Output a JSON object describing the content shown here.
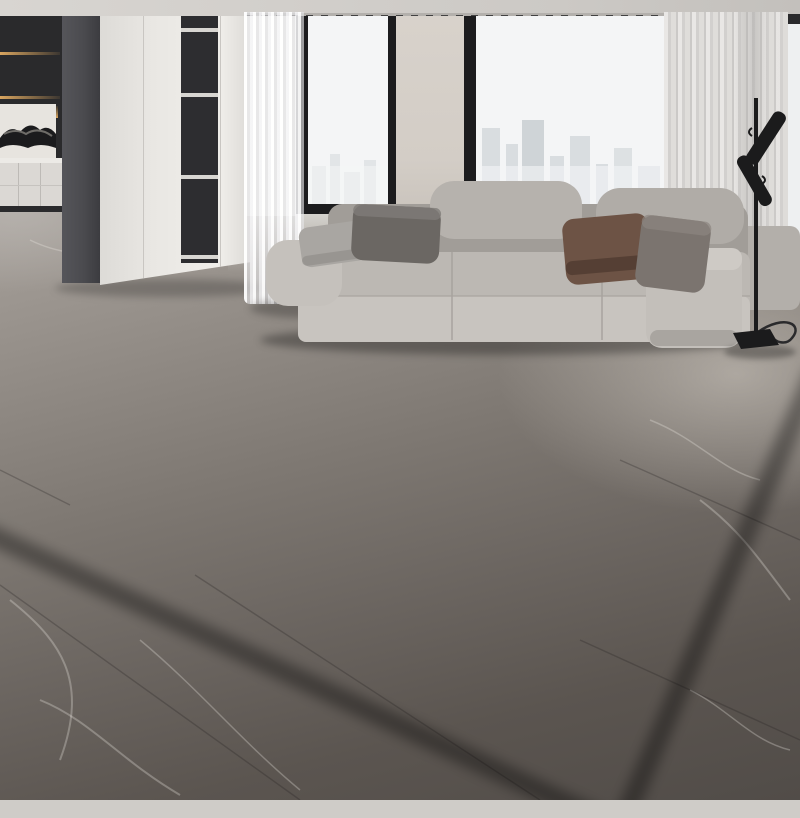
{
  "image": {
    "kind": "product-photo",
    "subject": "gold greek-key marble-print area rug in a modern living room",
    "width_px": 800,
    "height_px": 800
  },
  "palette": {
    "ceiling": "#d8d5d1",
    "track": "#b3b0ac",
    "window_frame": "#1c1c1e",
    "window_view": "#f4f5f6",
    "skyline": "#d9dde0",
    "wall_pier": "#d3cdc6",
    "curtain_left": "#f5f4f3",
    "curtain_right": "#dbd9d7",
    "kitchen_dark": "#2a2a2c",
    "kitchen_glow": "#d9a55f",
    "counter": "#eceae6",
    "base_cabinet": "#dbd8d4",
    "partition": "#4b4b4f",
    "wardrobe": "#e9e7e3",
    "niche": "#2d2d30",
    "floor_light": "#a8a29c",
    "floor_dark": "#514c48",
    "floor_vein": "#eeece6",
    "sofa": "#bcb8b3",
    "sofa_dark": "#a19d98",
    "pillow_gray": "#a9a6a2",
    "pillow_dark": "#6b6763",
    "pillow_brown": "#6d5345",
    "pillow_taupe": "#7b746f",
    "lamp": "#1b1b1c",
    "rug_binding": "#f2ecdd",
    "rug_margin": "#d8cfbc",
    "rug_grid_gold": "#c79d35",
    "rug_trim_light": "#fdf3b8",
    "rug_trim_mid": "#ddb84d",
    "rug_trim_dark": "#8a671f",
    "rug_band": "#8d7c67",
    "rug_band_dark": "#6f5f4c",
    "rug_key_gold": "#f1dd90",
    "rug_key_shadow": "#66501f",
    "rug_black": "#17171a",
    "rug_white": "#e9eaec",
    "rug_gold": "#dfae45",
    "rug_gold_light": "#f4d87c",
    "rug_gold_dark": "#a07a20"
  },
  "scene": {
    "setting": "modern high-rise living room",
    "rug": {
      "shape": "rectangle",
      "border_pattern": "greek-key meander on taupe band with gold bevel trim",
      "outer_field": "beige marble with gold diamond lattice and star sparkles",
      "inner_field": "black and white marble with gold foil veining and splatter",
      "edge": "cream binding"
    },
    "sofa": {
      "style": "modular with fold-down headrests",
      "pillow_count": 4
    },
    "lamp": {
      "type": "floor lamp",
      "heads": 2,
      "base": "square plate with cord"
    },
    "windows": {
      "count": 2,
      "view": "hazy city skyline",
      "curtains": "sheer"
    },
    "left_wall": [
      "backlit display shelving",
      "stone art backsplash",
      "white base cabinets",
      "white wardrobe partition with open niches"
    ]
  }
}
